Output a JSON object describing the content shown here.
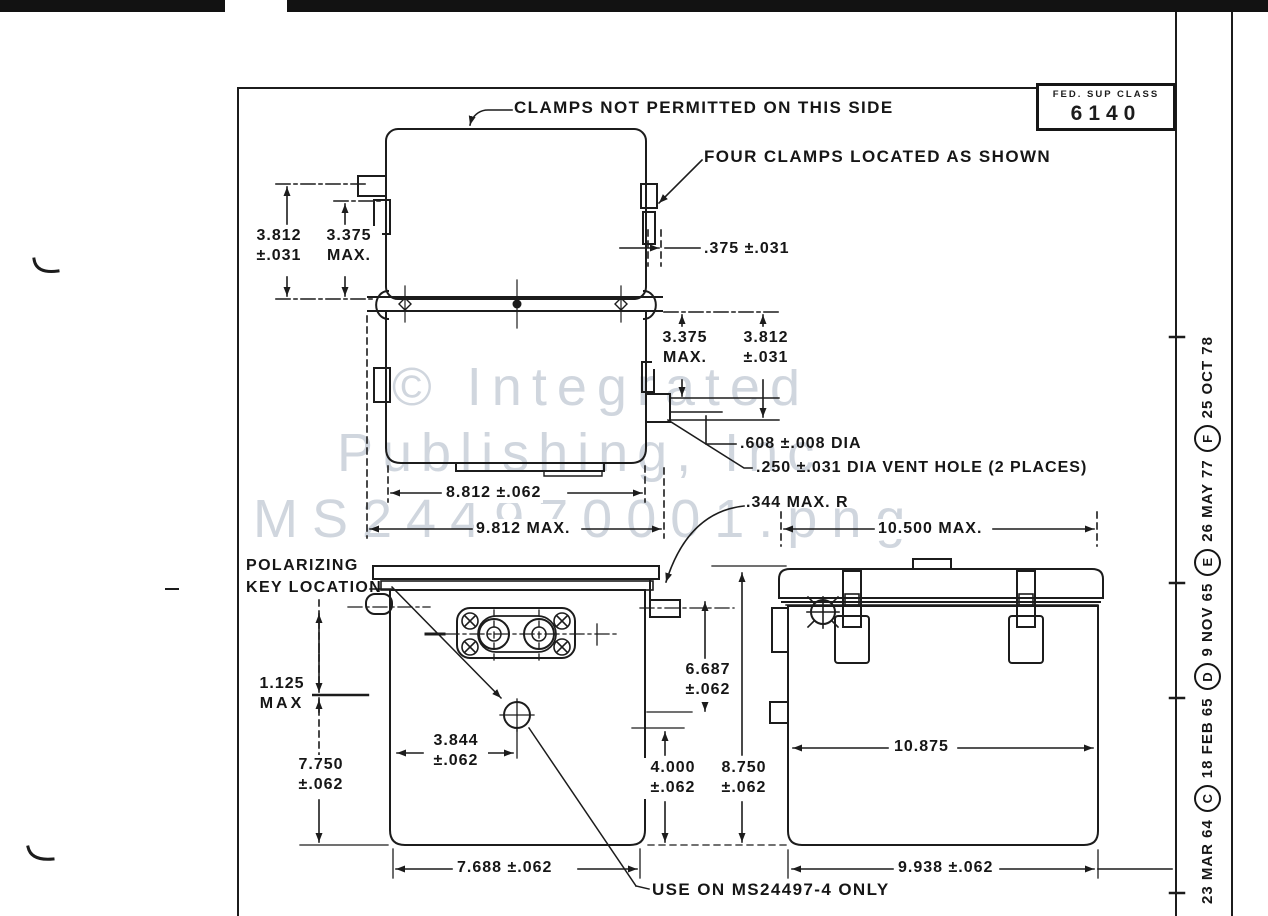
{
  "colors": {
    "ink": "#1c1c1c",
    "paper": "#ffffff",
    "watermark": "#aab5c2"
  },
  "title_block": {
    "fed_sup_class_label": "FED. SUP CLASS",
    "fed_sup_class_value": "6140"
  },
  "revision_strip": {
    "entries": [
      {
        "text": "23 MAR 64"
      },
      {
        "text": "C"
      },
      {
        "text": "18 FEB 65"
      },
      {
        "text": "D"
      },
      {
        "text": "9 NOV 65"
      },
      {
        "text": "E"
      },
      {
        "text": "26 MAY 77"
      },
      {
        "text": "F"
      },
      {
        "text": "25 OCT 78"
      }
    ]
  },
  "labels": {
    "clamps_note": "CLAMPS NOT PERMITTED ON THIS SIDE",
    "four_clamps_note": "FOUR CLAMPS LOCATED AS SHOWN",
    "polarizing_key": {
      "l1": "POLARIZING",
      "l2": "KEY LOCATION"
    },
    "use_on_note": "USE ON MS24497-4 ONLY"
  },
  "dims": {
    "d3812L": {
      "l1": "3.812",
      "l2": "±.031"
    },
    "d3375L": {
      "l1": "3.375",
      "l2": "MAX."
    },
    "d375": {
      "l1": ".375 ±.031"
    },
    "d3375R": {
      "l1": "3.375",
      "l2": "MAX."
    },
    "d3812R": {
      "l1": "3.812",
      "l2": "±.031"
    },
    "d608": {
      "l1": ".608 ±.008 DIA"
    },
    "d250": {
      "l1": ".250 ±.031 DIA VENT HOLE (2 PLACES)"
    },
    "d8812": {
      "l1": "8.812 ±.062"
    },
    "d9812": {
      "l1": "9.812 MAX."
    },
    "d344": {
      "l1": ".344 MAX. R"
    },
    "d10500": {
      "l1": "10.500 MAX."
    },
    "d1125": {
      "l1": "1.125",
      "l2": "MAX"
    },
    "d7750": {
      "l1": "7.750",
      "l2": "±.062"
    },
    "d3844": {
      "l1": "3.844",
      "l2": "±.062"
    },
    "d6687": {
      "l1": "6.687",
      "l2": "±.062"
    },
    "d4000": {
      "l1": "4.000",
      "l2": "±.062"
    },
    "d8750": {
      "l1": "8.750",
      "l2": "±.062"
    },
    "d7688": {
      "l1": "7.688 ±.062"
    },
    "d10875": {
      "l1": "10.875"
    },
    "d9938": {
      "l1": "9.938 ±.062"
    }
  },
  "watermark": {
    "line1": "© Integrated",
    "line2": "Publishing, Inc",
    "line3": "MS244970001.png"
  }
}
